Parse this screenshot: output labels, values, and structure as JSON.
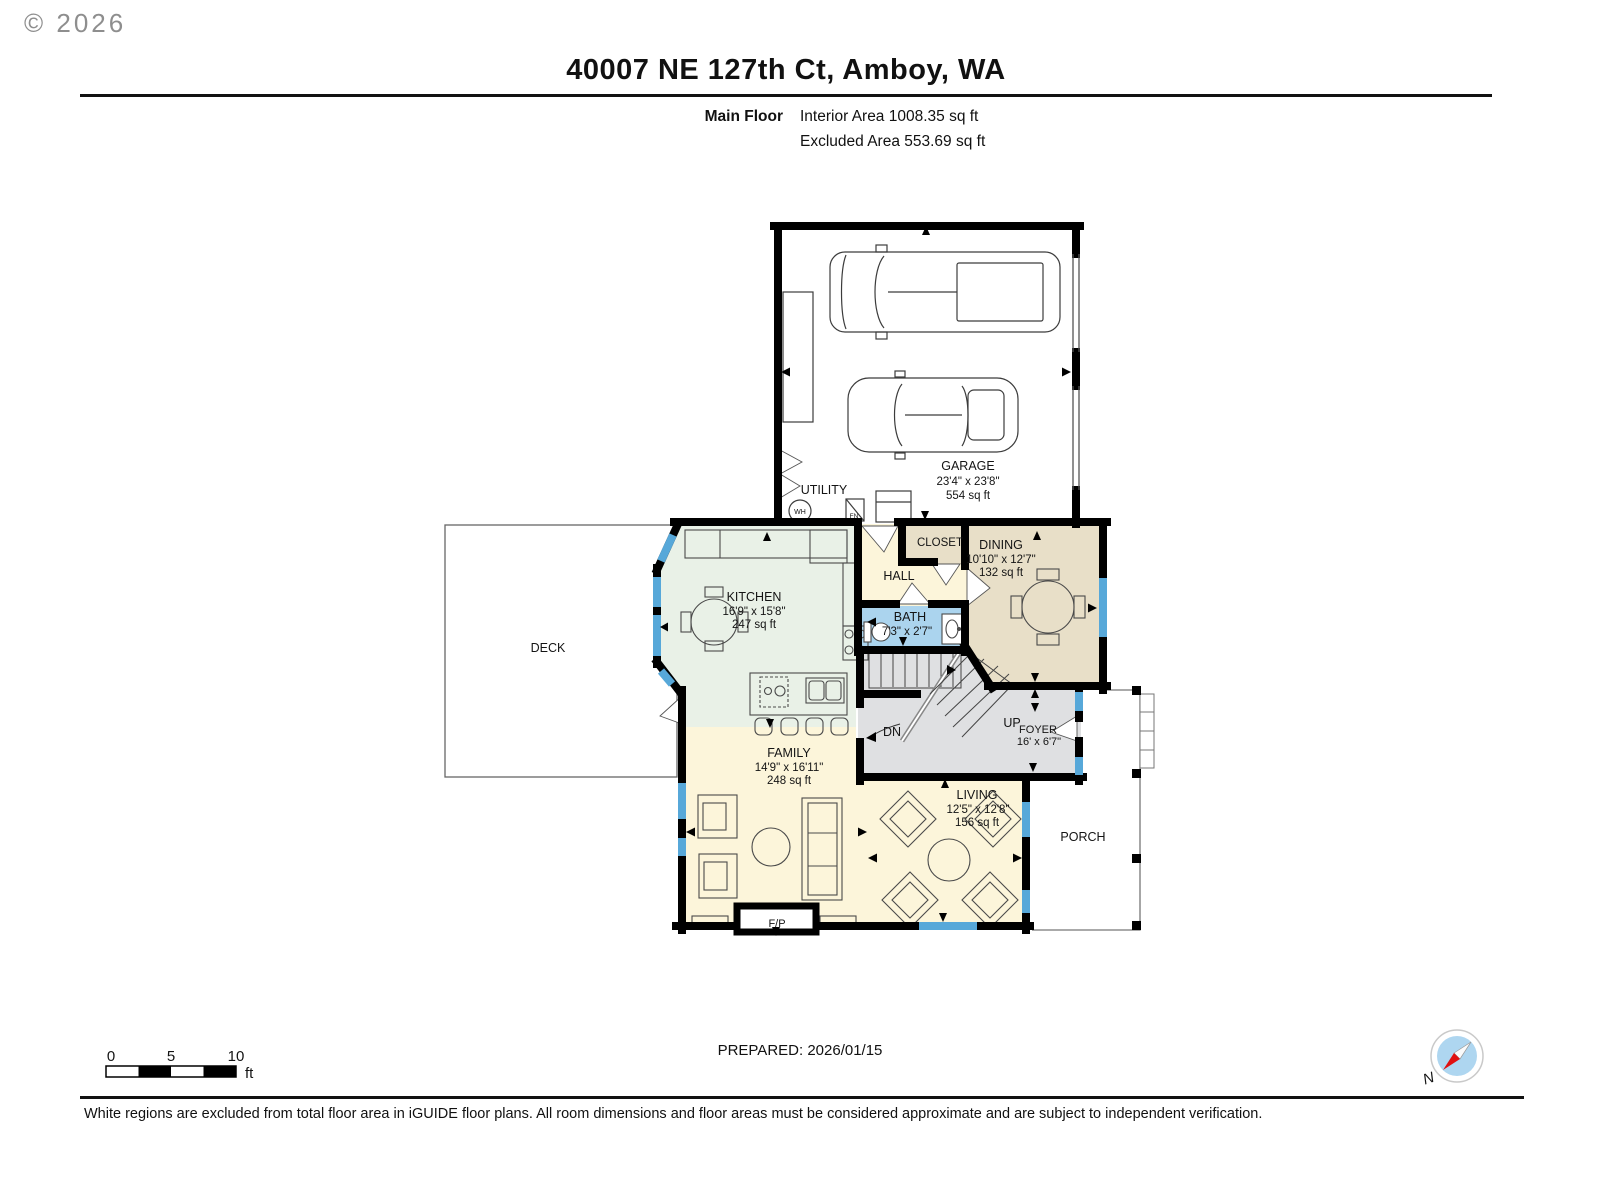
{
  "page": {
    "copyright": "© 2026",
    "title": "40007 NE 127th Ct, Amboy, WA",
    "floor_label": "Main Floor",
    "interior_area": "Interior Area 1008.35 sq ft",
    "excluded_area": "Excluded Area 553.69 sq ft",
    "prepared": "PREPARED: 2026/01/15",
    "disclaimer": "White regions are excluded from total floor area in iGUIDE floor plans. All room dimensions and floor areas must be considered approximate and are subject to independent verification."
  },
  "scale_bar": {
    "t0": "0",
    "t5": "5",
    "t10": "10",
    "unit": "ft"
  },
  "compass": {
    "north": "N"
  },
  "rooms": {
    "garage": {
      "name": "GARAGE",
      "dims": "23'4\" x 23'8\"",
      "area": "554 sq ft"
    },
    "utility": {
      "name": "UTILITY",
      "water_heater": "WH",
      "furnace": "FN"
    },
    "kitchen": {
      "name": "KITCHEN",
      "dims": "16'9\" x 15'8\"",
      "area": "247 sq ft"
    },
    "closet": {
      "name": "CLOSET"
    },
    "hall": {
      "name": "HALL"
    },
    "dining": {
      "name": "DINING",
      "dims": "10'10\" x 12'7\"",
      "area": "132 sq ft"
    },
    "bath": {
      "name": "BATH",
      "dims": "7'3\" x 2'7\""
    },
    "family": {
      "name": "FAMILY",
      "dims": "14'9\" x 16'11\"",
      "area": "248 sq ft"
    },
    "living": {
      "name": "LIVING",
      "dims": "12'5\" x 12'8\"",
      "area": "156 sq ft"
    },
    "foyer": {
      "name": "FOYER",
      "dims": "16' x 6'7\""
    },
    "deck": {
      "name": "DECK"
    },
    "porch": {
      "name": "PORCH"
    },
    "stairs": {
      "up": "UP",
      "down": "DN"
    },
    "fireplace": {
      "label": "F/P"
    }
  },
  "colors": {
    "interior_cream": "#fcf5da",
    "kitchen_green": "#e9f1e7",
    "dining_tan": "#e8dfc8",
    "bath_blue": "#abd4ee",
    "stairs_gray": "#dfe0e2",
    "window_blue": "#57a8d9",
    "wall_black": "#000000",
    "compass_blue": "#aed6f0",
    "compass_red": "#e01010"
  }
}
